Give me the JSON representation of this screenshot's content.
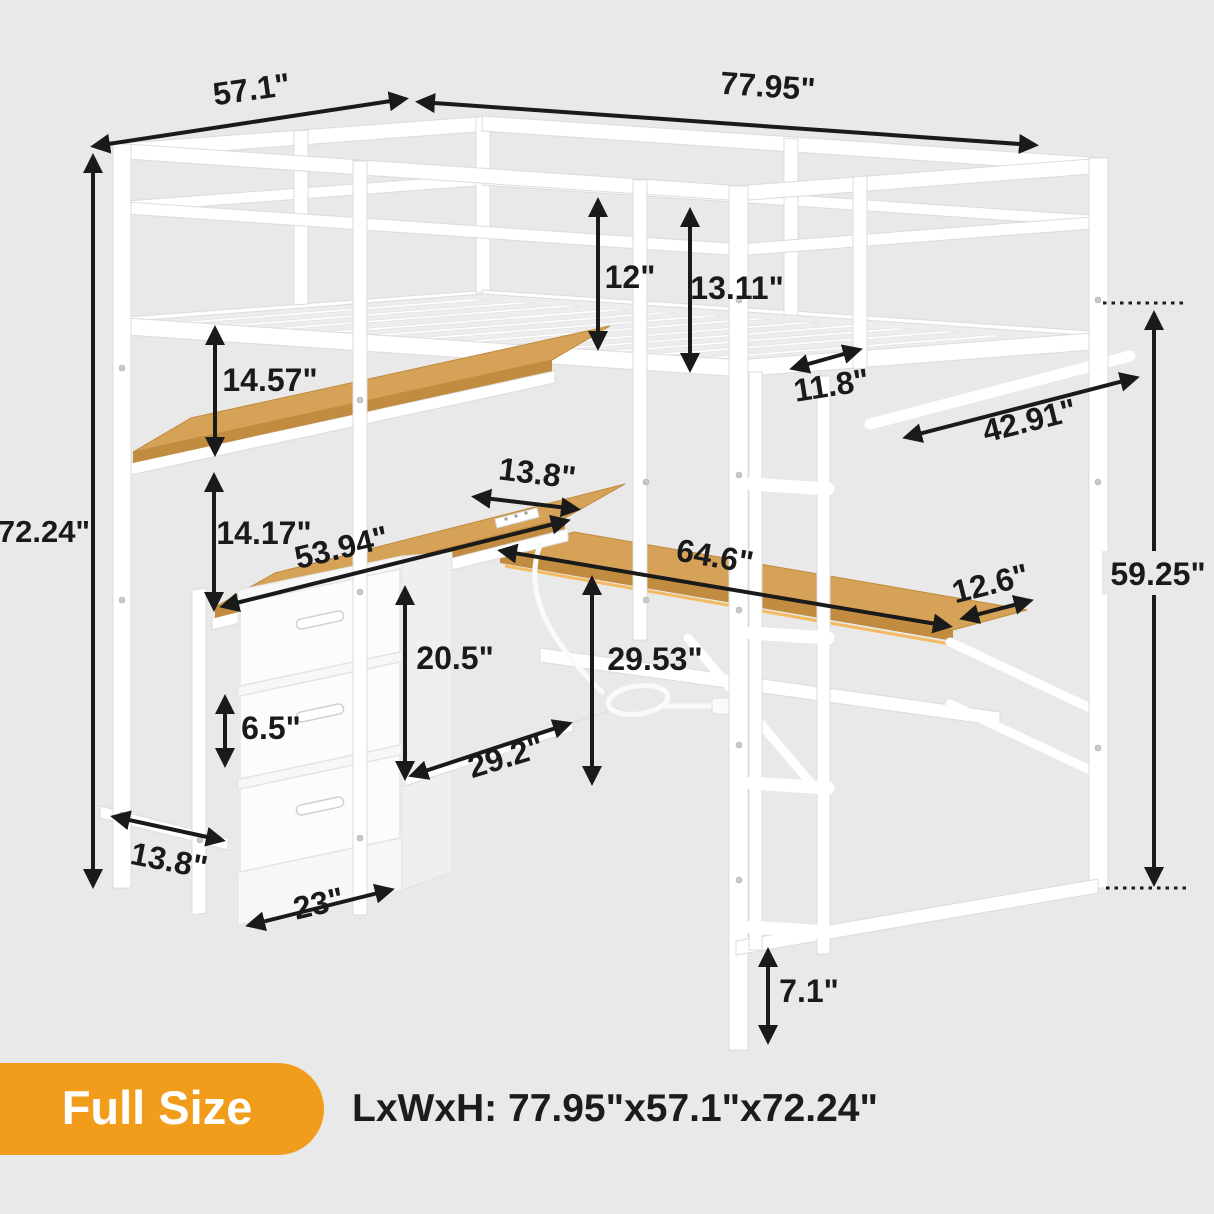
{
  "badge": {
    "label": "Full Size",
    "color": "#F29C1B"
  },
  "summary": {
    "text": "LxWxH: 77.95\"x57.1\"x72.24\""
  },
  "colors": {
    "background": "#e9e9e9",
    "frame_white": "#ffffff",
    "wood": "#d6a258",
    "annotation": "#1a1a1a",
    "badge_orange": "#F29C1B"
  },
  "dimensions": {
    "top_width": "57.1\"",
    "top_length": "77.95\"",
    "total_height": "72.24\"",
    "guardrail_front_height": "12\"",
    "guardrail_side_height": "13.11\"",
    "rail_gap": "11.8\"",
    "upper_shelf_gap": "14.57\"",
    "hanging_rod_length": "42.91\"",
    "desk_corner_depth": "13.8\"",
    "lower_shelf_gap": "14.17\"",
    "side_desk_length": "53.94\"",
    "front_desk_length": "64.6\"",
    "front_desk_depth": "12.6\"",
    "under_bed_clearance": "59.25\"",
    "desk_clearance_height": "29.53\"",
    "cubby_height": "20.5\"",
    "drawer_height": "6.5\"",
    "mesh_shelf_width": "29.2\"",
    "drawer_unit_width": "23\"",
    "side_bottom_depth": "13.8\"",
    "leg_height": "7.1\""
  }
}
